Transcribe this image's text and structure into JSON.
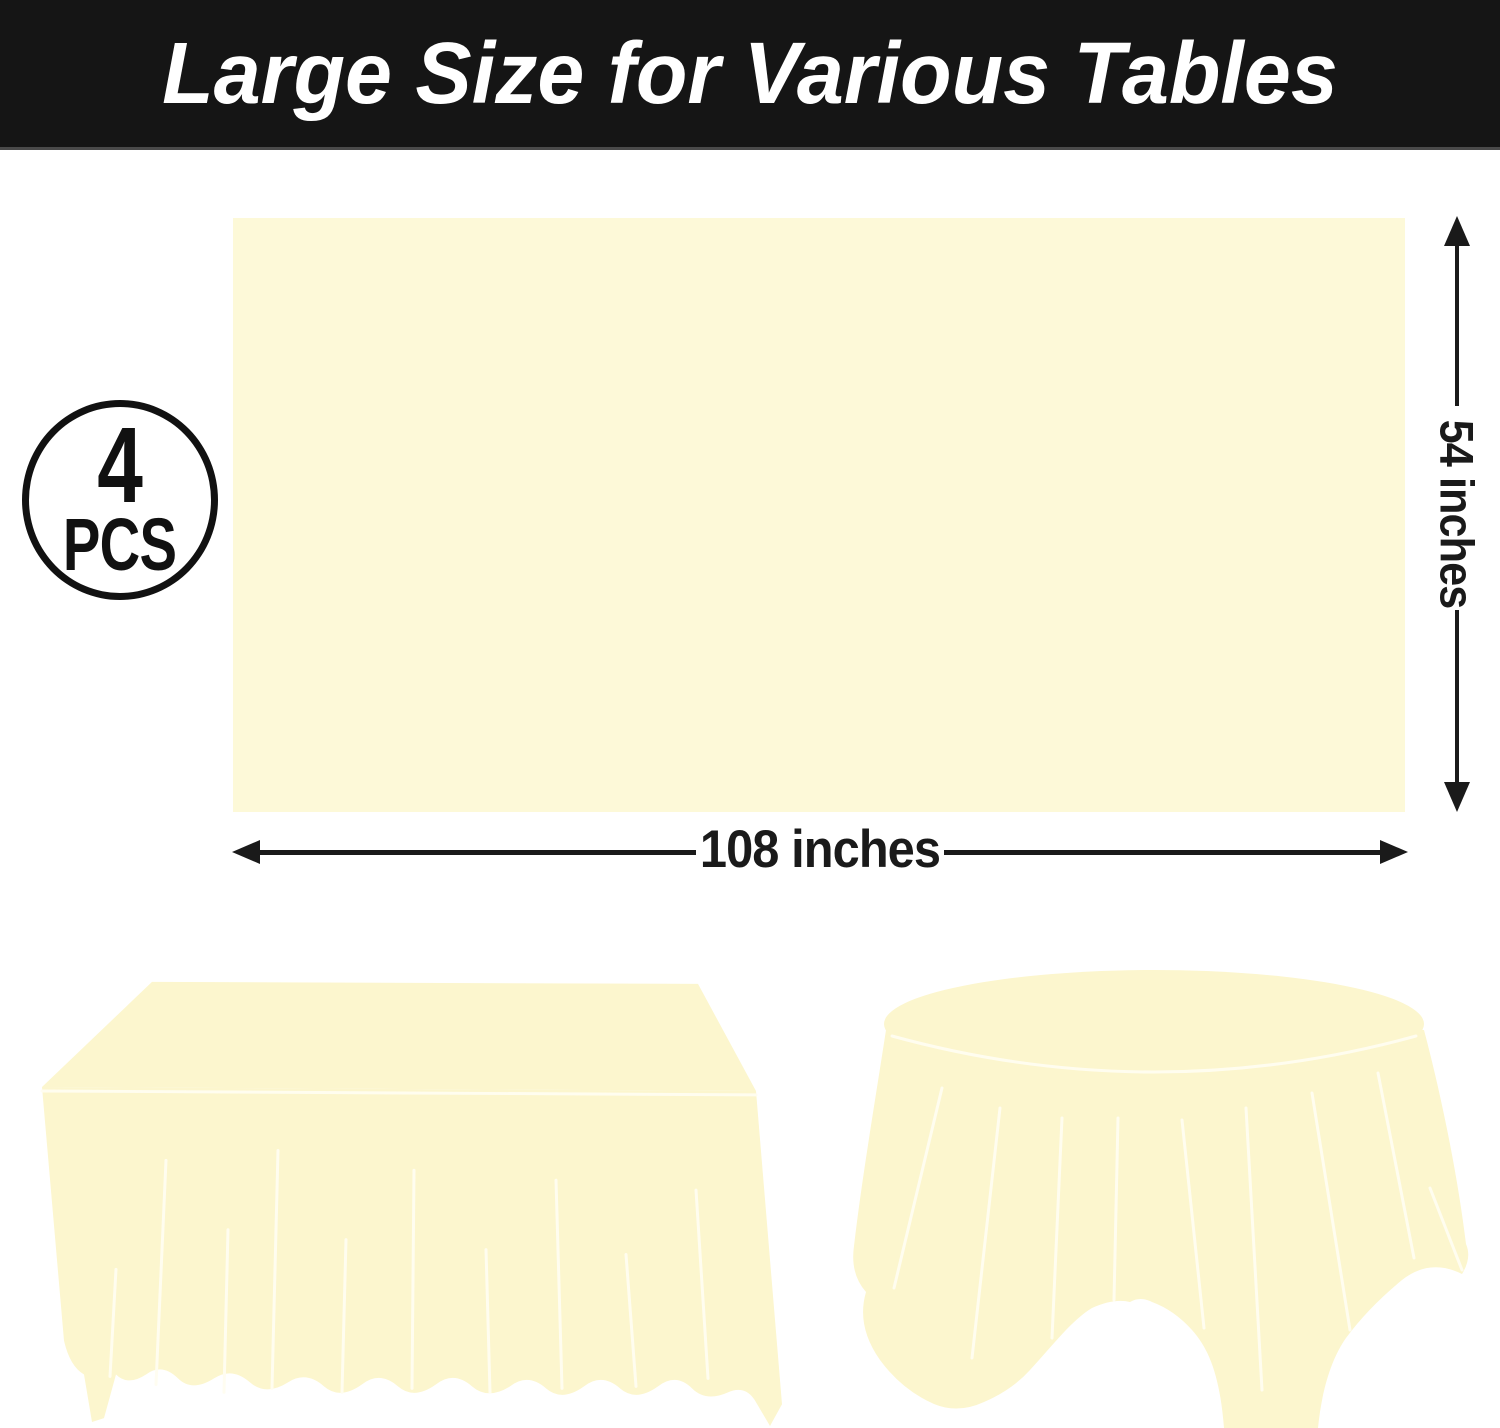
{
  "banner": {
    "title": "Large Size for Various Tables",
    "background_color": "#151515",
    "text_color": "#FFFFFF"
  },
  "badge": {
    "count": "4",
    "unit": "PCS",
    "ring_color": "#111111"
  },
  "swatch": {
    "fill_color": "#FDF9D8"
  },
  "dimensions": {
    "height_label": "54 inches",
    "width_label": "108 inches",
    "line_color": "#1A1A1A"
  },
  "tables": {
    "cloth_color": "#FCF6CE",
    "fold_line_color": "#FFFDF0",
    "left_illustration": "rectangular-table-with-tablecloth",
    "right_illustration": "round-table-with-tablecloth"
  }
}
